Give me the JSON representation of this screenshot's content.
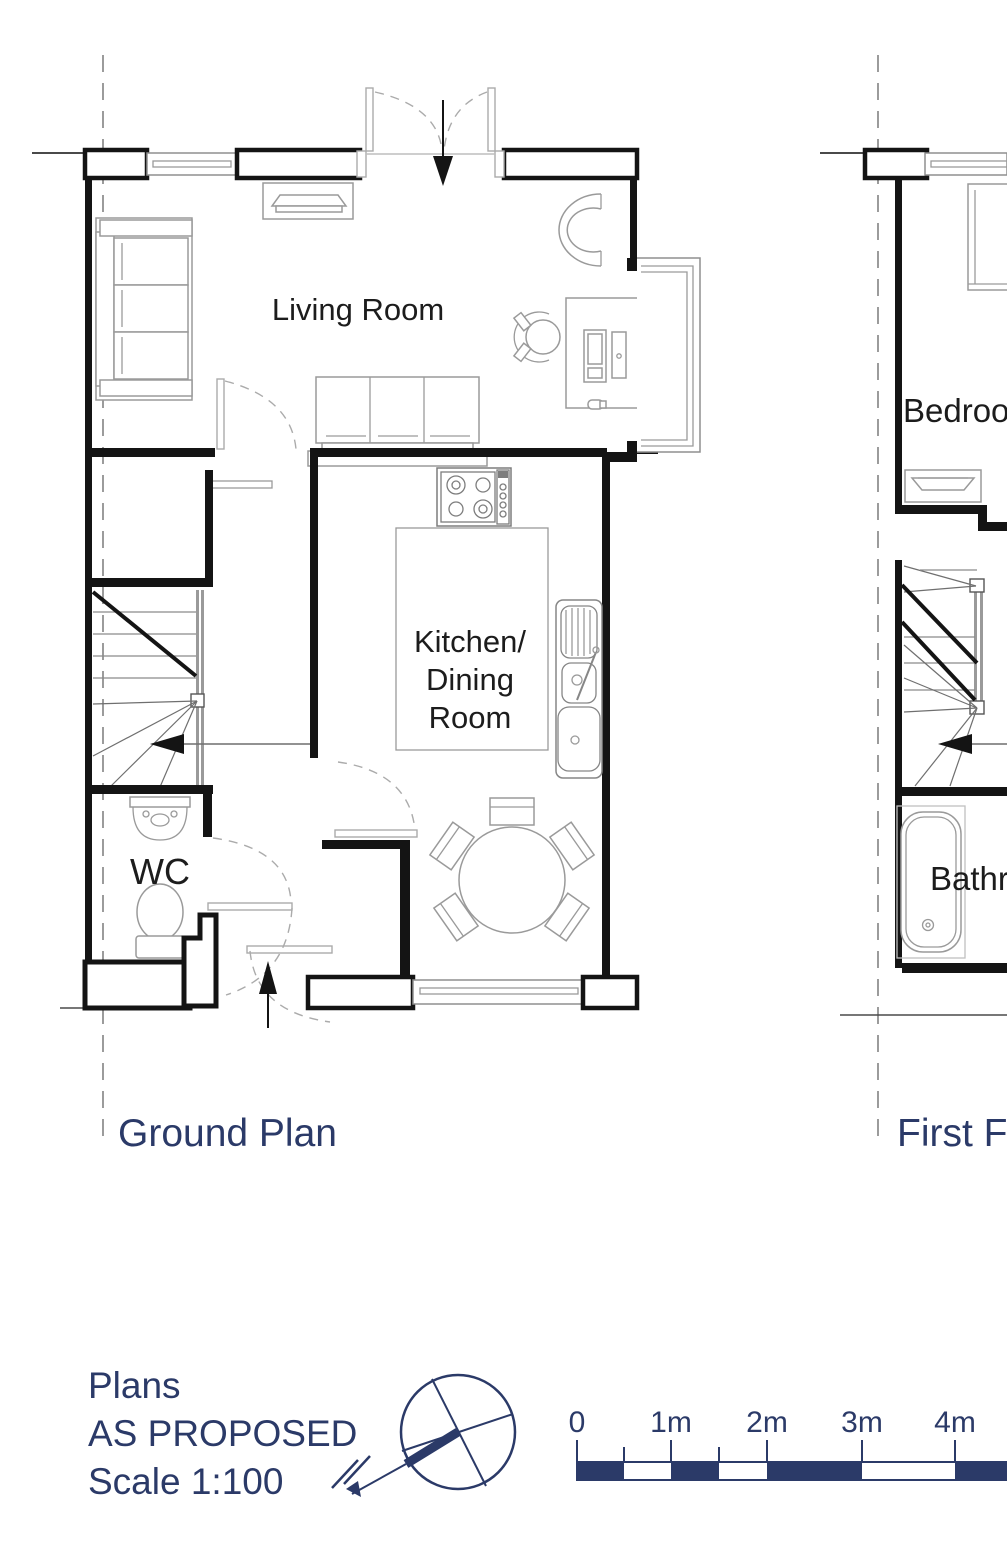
{
  "ground_plan": {
    "title": "Ground Plan",
    "labels": {
      "living_room": "Living Room",
      "kitchen_1": "Kitchen/",
      "kitchen_2": "Dining",
      "kitchen_3": "Room",
      "wc": "WC"
    }
  },
  "first_floor_plan": {
    "title": "First Floor Plan",
    "labels": {
      "bedroom": "Bedroom",
      "bathroom": "Bathroom"
    }
  },
  "title_block": {
    "line1": "Plans",
    "line2": "AS PROPOSED",
    "line3": "Scale 1:100"
  },
  "scale_bar": {
    "labels": [
      "0",
      "1m",
      "2m",
      "3m",
      "4m"
    ]
  },
  "colors": {
    "navy": "#2b3a68",
    "plan_line": "#141414",
    "furniture_line": "#9a9a9a"
  }
}
